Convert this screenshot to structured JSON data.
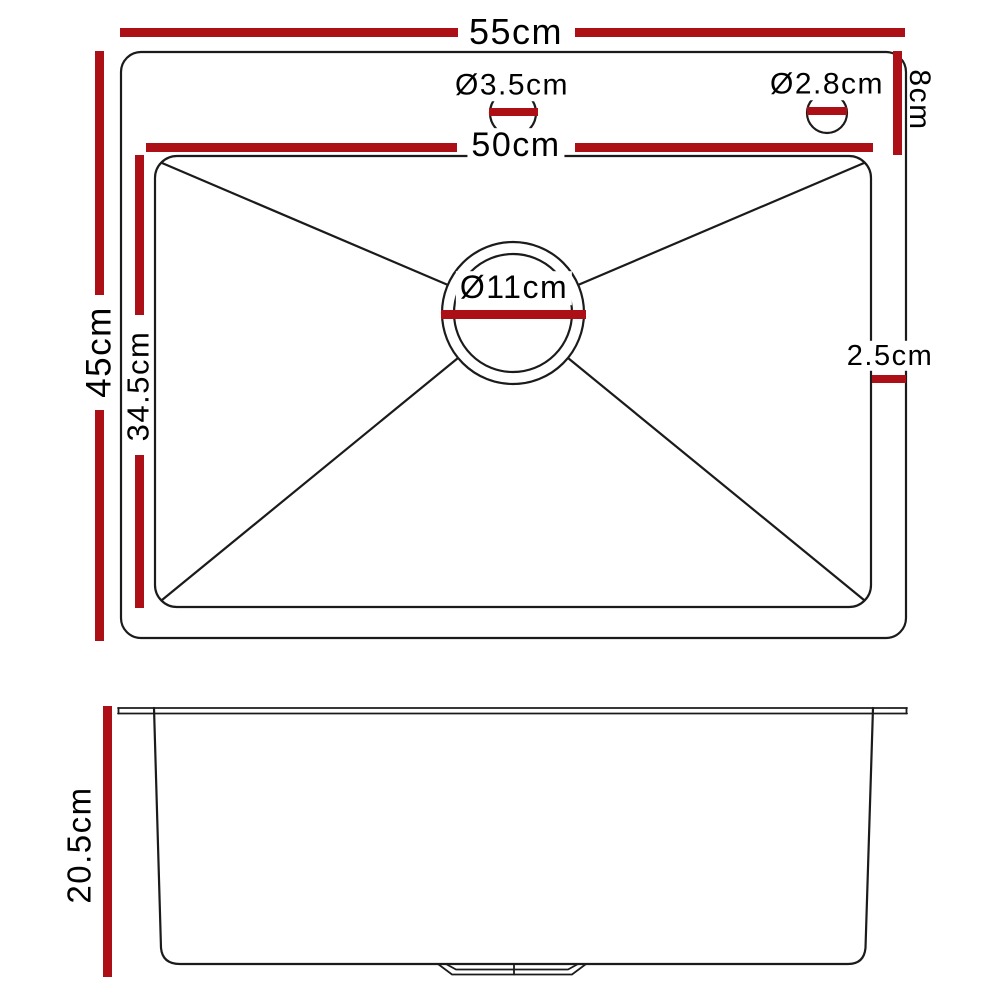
{
  "colors": {
    "dimension_red": "#ac1016",
    "line_black": "#1b1b1b"
  },
  "top_view": {
    "overall_width_label": "55cm",
    "inner_width_label": "50cm",
    "overall_depth_label": "45cm",
    "inner_depth_label": "34.5cm",
    "rim_top_right_label": "8cm",
    "rim_right_gap_label": "2.5cm",
    "drain_diameter_label": "Ø11cm",
    "left_hole_diameter_label": "Ø3.5cm",
    "right_hole_diameter_label": "Ø2.8cm"
  },
  "side_view": {
    "bowl_height_label": "20.5cm"
  }
}
